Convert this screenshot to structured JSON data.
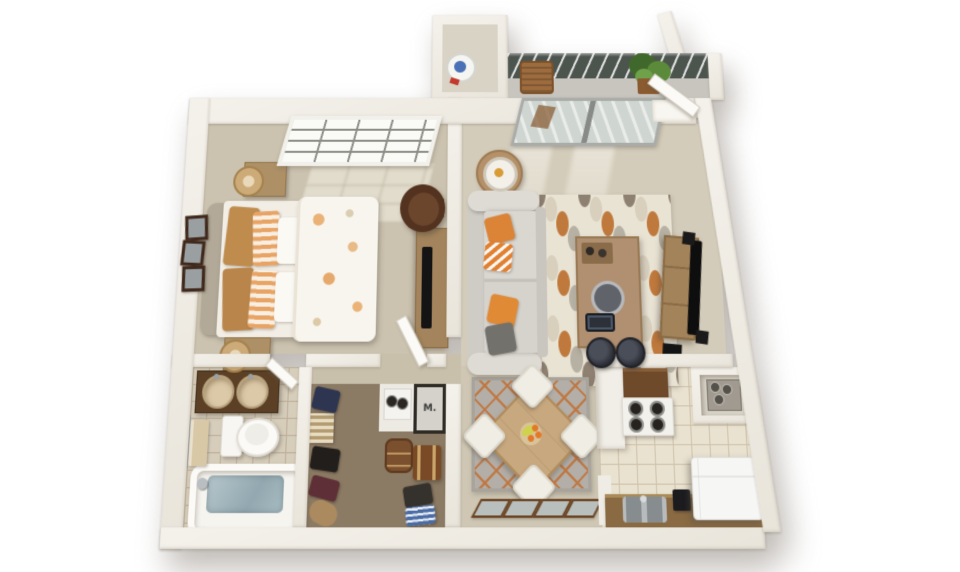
{
  "labels": {
    "mechanical_closet": "M."
  },
  "palette": {
    "wall": "#f0ede6",
    "bedroom_floor": "#cbc2af",
    "living_floor": "#d4ccba",
    "closet_carpet": "#8c7b64",
    "bath_tile": "#d7cdbb",
    "kitchen_tile": "#eae2d0",
    "wood_accent": "#a3845c",
    "orange_accent": "#db8438",
    "railing": "#4c544e",
    "water": "#a9bdc3"
  },
  "rooms": [
    {
      "name": "bedroom",
      "objects": [
        "double bed",
        "striped orange pillows",
        "floral duvet",
        "two nightstands",
        "wicker table lamps",
        "grid window",
        "three picture frames",
        "dresser with tv",
        "brown leather armchair"
      ]
    },
    {
      "name": "living-room",
      "objects": [
        "gray sofa",
        "orange and gray throw pillows",
        "patterned area rug",
        "wood coffee table",
        "round side table with lamp",
        "tv stand",
        "television",
        "speakers",
        "subwoofer",
        "sliding glass balcony door",
        "open entry door",
        "two bar stools"
      ]
    },
    {
      "name": "balcony",
      "objects": [
        "slatted railing",
        "potted plant",
        "wood chair"
      ]
    },
    {
      "name": "utility-closet",
      "objects": [
        "water heater"
      ]
    },
    {
      "name": "bathroom",
      "objects": [
        "double sink vanity",
        "toilet",
        "towel on bar",
        "bathtub with water"
      ]
    },
    {
      "name": "walk-in-closet",
      "objects": [
        "hanging clothes",
        "basket shelf",
        "duffel bag",
        "storage trunk",
        "round hamper",
        "washer",
        "mechanical unit"
      ]
    },
    {
      "name": "dining-area",
      "objects": [
        "square wood table",
        "four white chairs",
        "fruit bowl",
        "lattice rug",
        "leaning picture frames"
      ]
    },
    {
      "name": "kitchen",
      "objects": [
        "range with four burners",
        "overhead cabinet",
        "peninsula counter",
        "utility niche unit",
        "lower counter",
        "double sink",
        "coffee maker",
        "refrigerator"
      ]
    }
  ]
}
